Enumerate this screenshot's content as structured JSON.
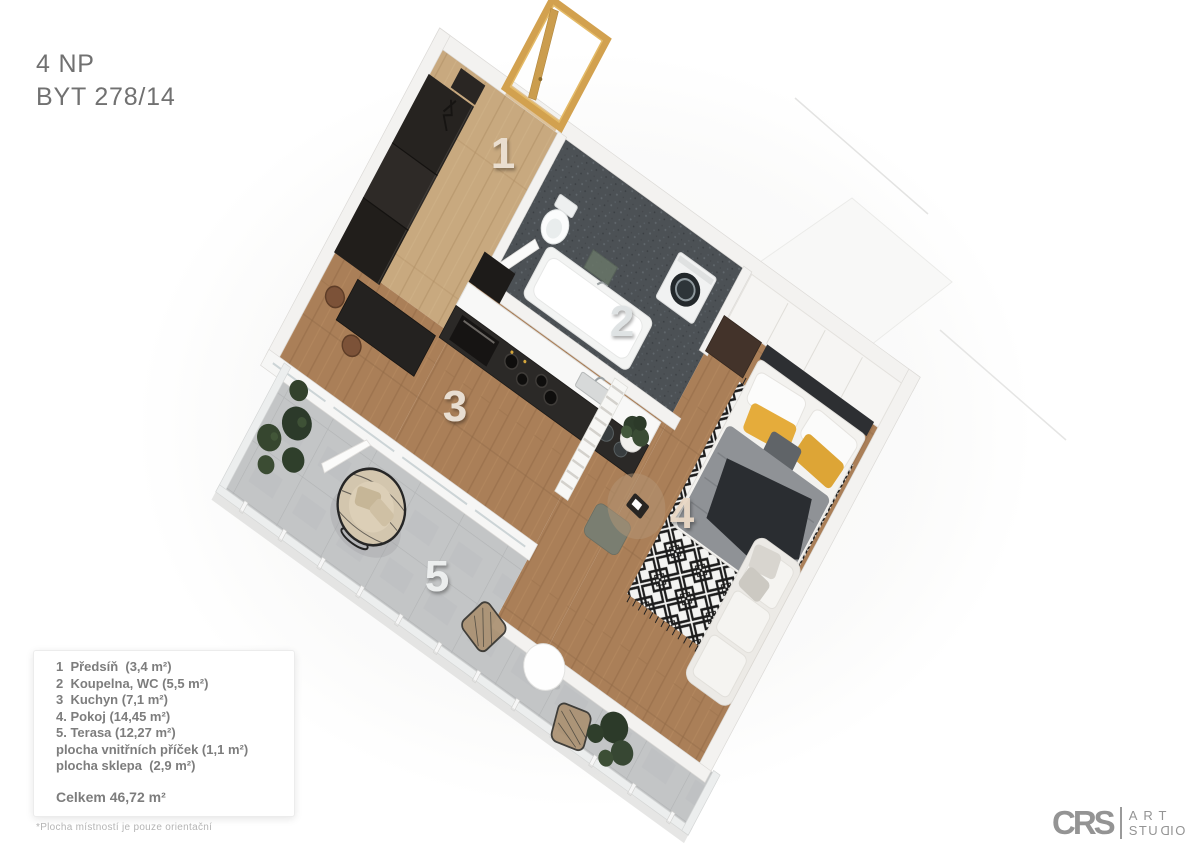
{
  "header": {
    "floor": "4 NP",
    "unit": "BYT 278/14"
  },
  "legend": {
    "items": [
      "1  Předsíň  (3,4 m²)",
      "2  Koupelna, WC (5,5 m²)",
      "3  Kuchyn (7,1 m²)",
      "4. Pokoj (14,45 m²)",
      "5. Terasa (12,27 m²)",
      "plocha vnitřních příček (1,1 m²)",
      "plocha sklepa  (2,9 m²)"
    ],
    "total": "Celkem 46,72 m²",
    "footnote": "*Plocha místností je pouze orientační"
  },
  "plan": {
    "room_numbers": [
      {
        "label": "1",
        "x": 503,
        "y": 168,
        "room": "Předsíň"
      },
      {
        "label": "2",
        "x": 622,
        "y": 336,
        "room": "Koupelna, WC"
      },
      {
        "label": "3",
        "x": 455,
        "y": 421,
        "room": "Kuchyn"
      },
      {
        "label": "4",
        "x": 682,
        "y": 528,
        "room": "Pokoj"
      },
      {
        "label": "5",
        "x": 437,
        "y": 591,
        "room": "Terasa"
      }
    ],
    "colors": {
      "wood_floor": "#aa7f58",
      "hall_floor": "#c8a97f",
      "bathroom_tile": "#4c5155",
      "terrace_floor": "#c3c5c6",
      "wall": "#f3f2f0",
      "accent_yellow": "#e2a93a",
      "door_gold": "#d2a14f",
      "furniture_dark": "#262320"
    }
  },
  "logo": {
    "brand": "CRS",
    "line1": "ART",
    "line2a": "STU",
    "line2b": "D",
    "line2c": "IO"
  }
}
